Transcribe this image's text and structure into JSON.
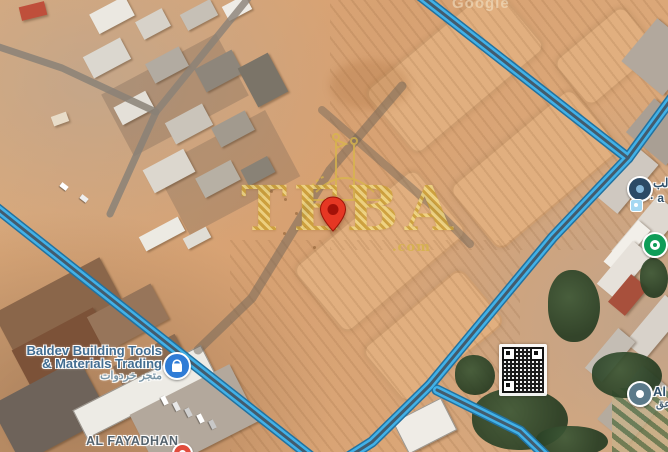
{
  "watermark": {
    "brand": "TEBA",
    "domain": ".com"
  },
  "map_attribution": "Google",
  "pois": {
    "baldev": {
      "name_line1": "Baldev Building Tools",
      "name_line2": "& Materials Trading",
      "name_ar": "متجر خردوات"
    },
    "al_fayadhan": {
      "label": "AL FAYADHAN"
    },
    "right_top": {
      "line1": "الب",
      "line2": "· a"
    },
    "right_bottom": {
      "line1": "Al",
      "line2": "عق"
    }
  },
  "colors": {
    "route_fill": "#41b1e8",
    "route_casing": "#23729f",
    "pin_red": "#e63723",
    "brand_gold": "#d7b34e",
    "poi_blue": "#2f7cd6",
    "poi_green": "#0f9d58"
  }
}
